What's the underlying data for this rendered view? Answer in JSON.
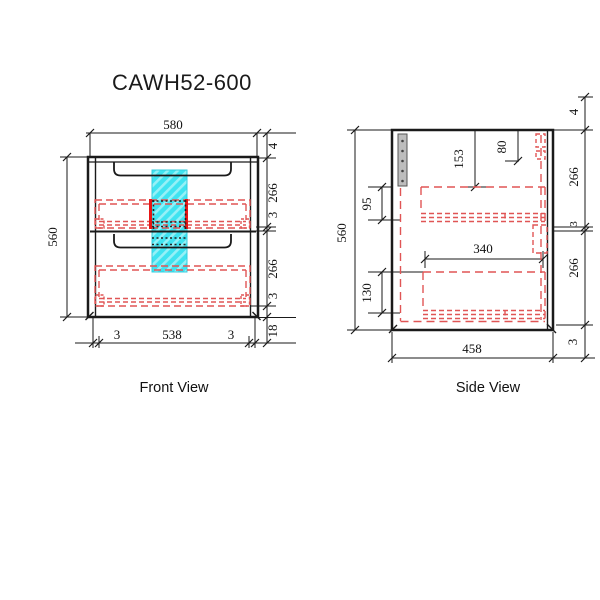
{
  "title": "CAWH52-600",
  "front_view": {
    "label": "Front View",
    "dim_width_top": "580",
    "dim_height": "560",
    "dim_top_gap": "4",
    "dim_drawer1_h": "266",
    "dim_gap1": "3",
    "dim_drawer2_h": "266",
    "dim_gap2": "3",
    "dim_bottom_kick": "18",
    "dim_side_thickness_left": "3",
    "dim_inner_width": "538",
    "dim_side_thickness_right": "3"
  },
  "side_view": {
    "label": "Side View",
    "dim_height": "560",
    "dim_top_gap": "4",
    "dim_drawer1_h": "266",
    "dim_gap1": "3",
    "dim_drawer2_h": "266",
    "dim_gap2": "3",
    "dim_cutout_drop": "153",
    "dim_back_rail_drop": "80",
    "dim_drawer1_back_h": "95",
    "dim_drawer2_back_h": "130",
    "dim_drawer_depth": "340",
    "dim_depth": "458"
  },
  "colors": {
    "line": "#1a1a1a",
    "hidden_red": "#e05555",
    "hidden_red_bold": "#e81616",
    "cutout_cyan": "#3fe3f0",
    "bracket_gray": "#bdbdbd"
  }
}
